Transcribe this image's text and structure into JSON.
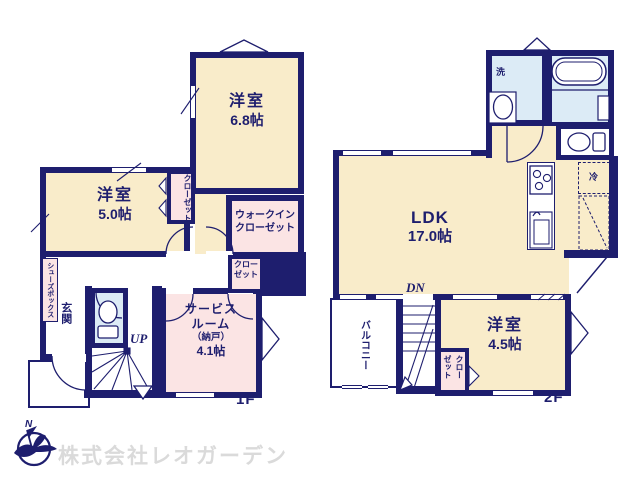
{
  "colors": {
    "wall_navy": "#1e1e6e",
    "room_cream": "#f9ecca",
    "closet_pink": "#fbe4e4",
    "wet_blue": "#dcebf6",
    "watermark_gray": "#dadada"
  },
  "floor1": {
    "label": "1F",
    "room68": {
      "name": "洋室",
      "size": "6.8帖"
    },
    "room50": {
      "name": "洋室",
      "size": "5.0帖"
    },
    "closet_tall": "クローゼット",
    "wic": {
      "line1": "ウォークイン",
      "line2": "クローゼット"
    },
    "closet_small": {
      "line1": "クロー",
      "line2": "ゼット"
    },
    "service": {
      "line1": "サービス",
      "line2": "ルーム",
      "line3": "（納戸）",
      "line4": "4.1帖"
    },
    "genkan": "玄関",
    "shoes": "シューズボックス",
    "stairs_label": "UP"
  },
  "floor2": {
    "label": "2F",
    "ldk": {
      "name": "LDK",
      "size": "17.0帖"
    },
    "room45": {
      "name": "洋室",
      "size": "4.5帖"
    },
    "balcony": "バルコニー",
    "closet": "クローゼット",
    "laundry": "洗",
    "fridge": "冷",
    "stairs_label": "DN"
  },
  "footer": {
    "company": "株式会社レオガーデン",
    "compass_north": "N"
  }
}
